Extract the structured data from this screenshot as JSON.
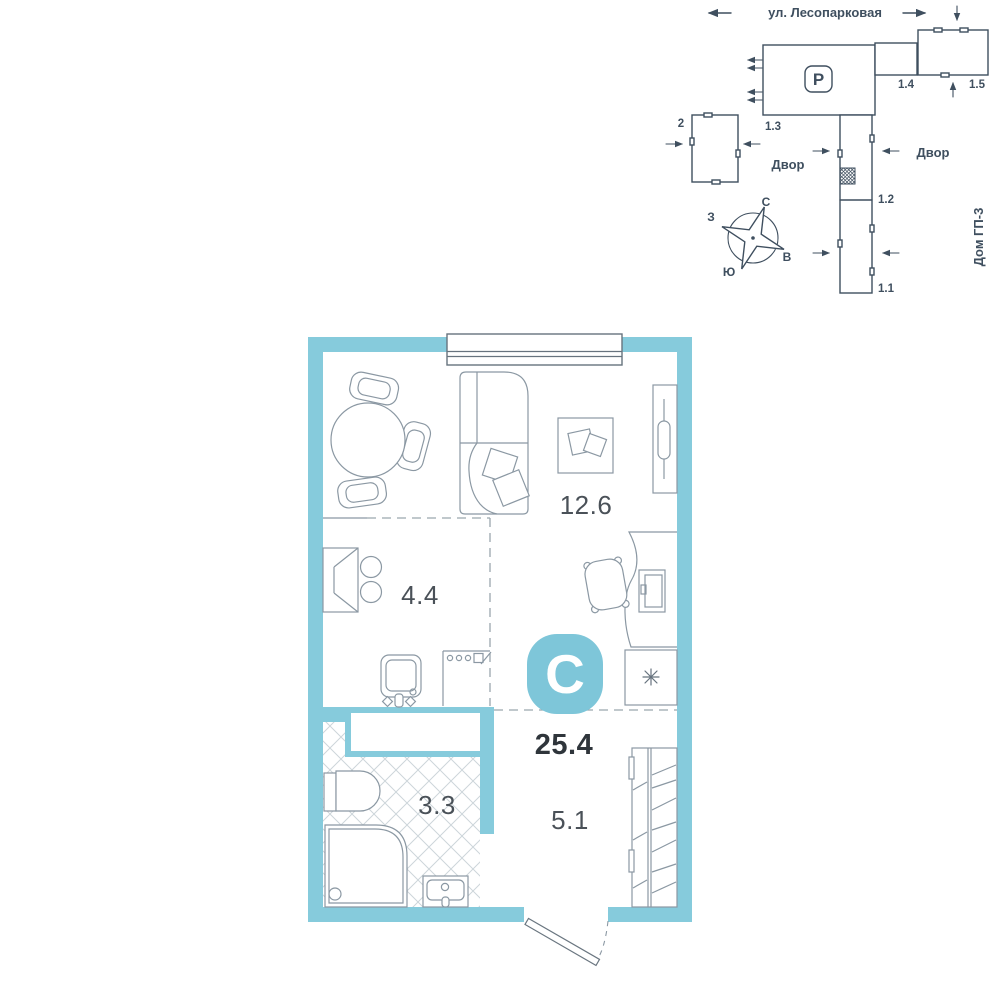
{
  "site_plan": {
    "street_label": "ул. Лесопарковая",
    "parking_symbol": "P",
    "building_2": "2",
    "building_1_1": "1.1",
    "building_1_2": "1.2",
    "building_1_3": "1.3",
    "building_1_4": "1.4",
    "building_1_5": "1.5",
    "courtyard_left": "Двор",
    "courtyard_right": "Двор",
    "house_name": "Дом ГП-3",
    "compass": {
      "north": "С",
      "south": "Ю",
      "west": "З",
      "east": "В"
    },
    "icons": {
      "parking_badge": "rounded-square with letter P",
      "compass_rose": "4-point star in circle",
      "unit_location_marker": "hatched square on building 1.2"
    }
  },
  "floor_plan": {
    "logo_letter": "С",
    "total_area": "25.4",
    "rooms": {
      "living_room": "12.6",
      "kitchen": "4.4",
      "bathroom": "3.3",
      "hallway": "5.1"
    },
    "icons": {
      "washing_machine": "asterisk symbol ✳",
      "entrance_door": "door leaf with dashed swing arc"
    }
  },
  "colors": {
    "wall_accent": "#86CBDC",
    "logo_teal": "#7EC6D9",
    "site_plan_ink": "#3F4F5F",
    "furniture_line": "#8B98A3",
    "area_text": "#2F353B",
    "room_label_text": "#4A5158"
  }
}
